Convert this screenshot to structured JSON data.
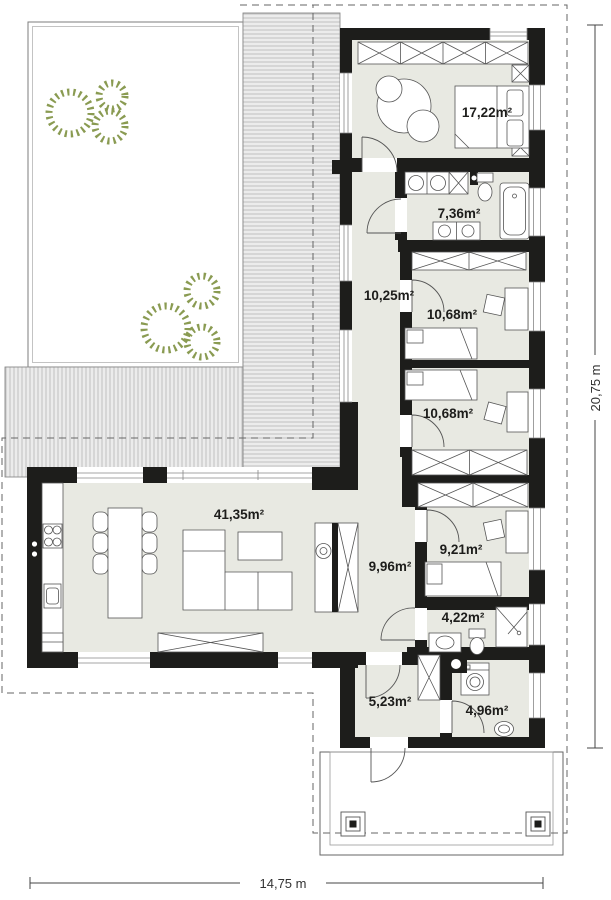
{
  "plan": {
    "rooms": [
      {
        "name": "bedroom-main",
        "area": "17,22m²"
      },
      {
        "name": "bathroom-main",
        "area": "7,36m²"
      },
      {
        "name": "hallway-upper",
        "area": "10,25m²"
      },
      {
        "name": "bedroom-2",
        "area": "10,68m²"
      },
      {
        "name": "bedroom-3",
        "area": "10,68m²"
      },
      {
        "name": "living-room",
        "area": "41,35m²"
      },
      {
        "name": "hallway-lower",
        "area": "9,96m²"
      },
      {
        "name": "bedroom-4",
        "area": "9,21m²"
      },
      {
        "name": "bathroom-2",
        "area": "4,22m²"
      },
      {
        "name": "entry-hall",
        "area": "5,23m²"
      },
      {
        "name": "utility-room",
        "area": "4,96m²"
      }
    ],
    "dimensions": {
      "width": "14,75 m",
      "depth": "20,75 m"
    },
    "colors": {
      "wall": "#1d1d1b",
      "floor": "#e8e9e2",
      "terrace_fill": "#ececec",
      "terrace_line": "#b5b5b5",
      "tree": "#8a9b52",
      "boundary": "#666666",
      "outline": "#555555"
    }
  }
}
